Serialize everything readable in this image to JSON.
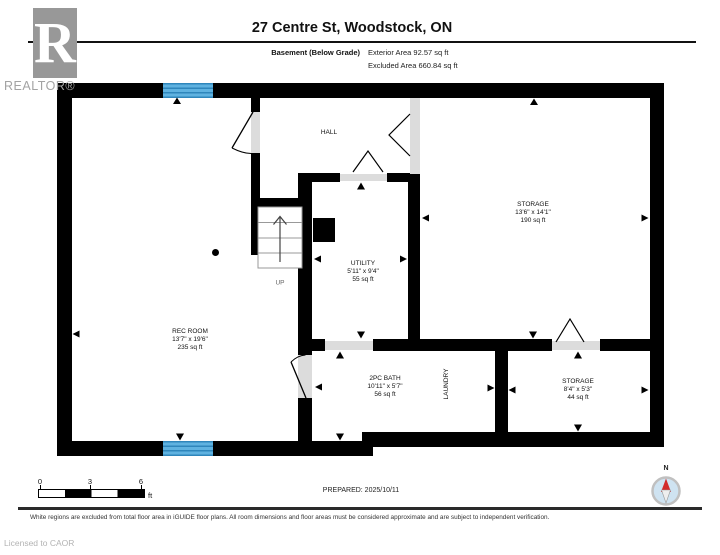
{
  "header": {
    "logo_letter": "R",
    "brand": "REALTOR®",
    "title": "27 Centre St, Woodstock, ON",
    "floor_label": "Basement (Below Grade)",
    "exterior_area": "Exterior Area 92.57 sq ft",
    "excluded_area": "Excluded Area 660.84 sq ft"
  },
  "rooms": {
    "hall": {
      "label": "HALL"
    },
    "storage_main": {
      "label": "STORAGE",
      "dims": "13'6\" x 14'1\"",
      "area": "190 sq ft"
    },
    "utility": {
      "label": "UTILITY",
      "dims": "5'11\" x 9'4\"",
      "area": "55 sq ft"
    },
    "rec_room": {
      "label": "REC ROOM",
      "dims": "13'7\" x 19'6\"",
      "area": "235 sq ft"
    },
    "bath": {
      "label": "2PC BATH",
      "dims": "10'11\" x 5'7\"",
      "area": "56 sq ft"
    },
    "laundry": {
      "label": "LAUNDRY"
    },
    "storage_small": {
      "label": "STORAGE",
      "dims": "8'4\" x 5'3\"",
      "area": "44 sq ft"
    }
  },
  "stairs": {
    "up_label": "UP"
  },
  "scale_bar": {
    "tick0": "0",
    "tick3": "3",
    "tick6": "6",
    "unit": "ft"
  },
  "compass": {
    "north_label": "N"
  },
  "footer": {
    "prepared": "PREPARED: 2025/10/11",
    "disclaimer": "White regions are excluded from total floor area in iGUIDE floor plans. All room dimensions and floor areas must be considered approximate and are subject to independent verification.",
    "license": "Licensed to CAOR"
  },
  "colors": {
    "wall_black": "#000000",
    "opening_gray": "#dcdcdc",
    "window_blue": "#5fb2e0",
    "window_blue_dark": "#2f86bb",
    "logo_gray": "#989898",
    "compass_red": "#d22b2b",
    "compass_fill": "#cfe3f1"
  }
}
